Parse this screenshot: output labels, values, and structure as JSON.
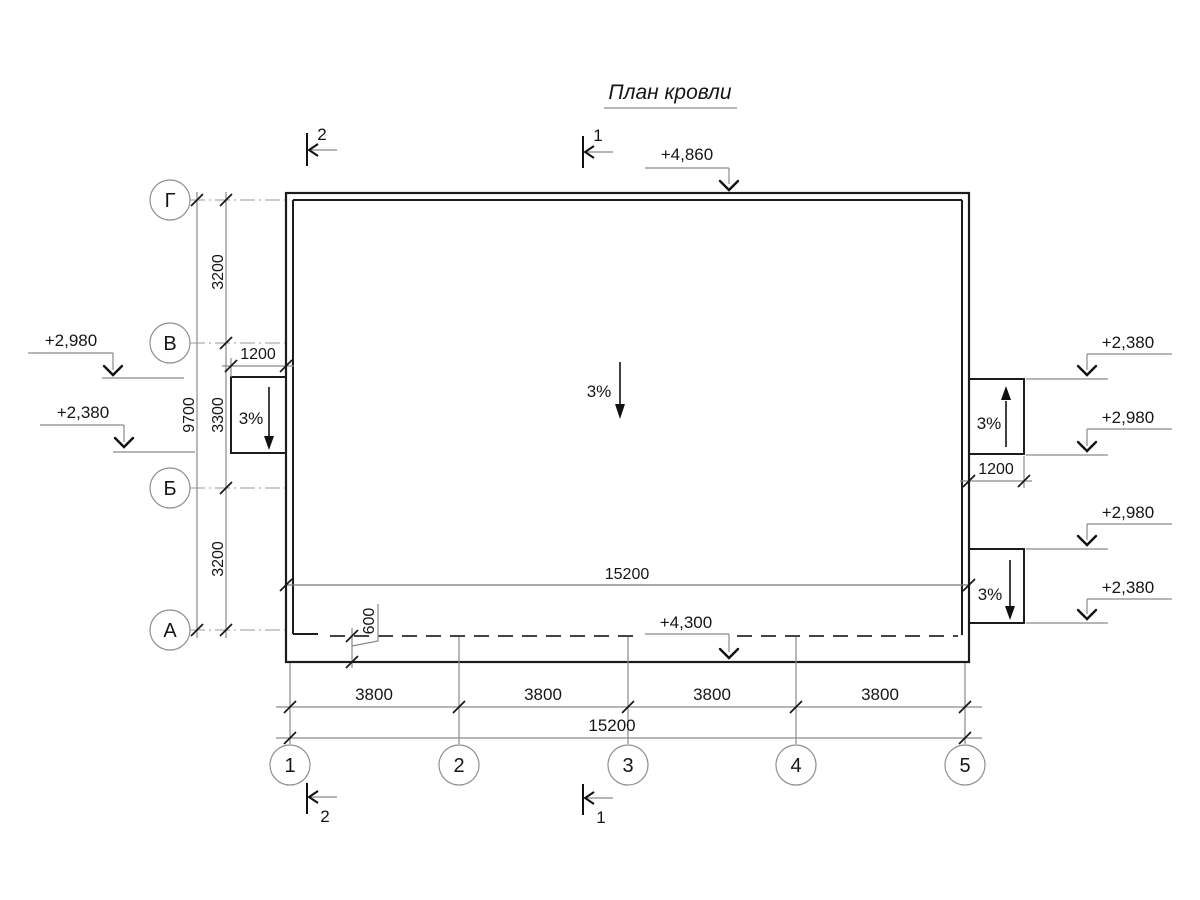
{
  "title": "План кровли",
  "sections": {
    "top_left": "2",
    "top_center": "1",
    "bottom_left": "2",
    "bottom_center": "1"
  },
  "elevations": {
    "ridge": "+4,860",
    "eaves": "+4,300",
    "left": [
      "+2,980",
      "+2,380"
    ],
    "right": [
      "+2,380",
      "+2,980",
      "+2,980",
      "+2,380"
    ]
  },
  "slopes": {
    "main": "3%",
    "left_canopy": "3%",
    "right_upper_canopy": "3%",
    "right_lower_canopy": "3%"
  },
  "grid": {
    "rows": [
      "Г",
      "В",
      "Б",
      "А"
    ],
    "columns": [
      "1",
      "2",
      "3",
      "4",
      "5"
    ]
  },
  "dimensions": {
    "row_spans": [
      "3200",
      "3300",
      "3200"
    ],
    "row_total": "9700",
    "column_spans": [
      "3800",
      "3800",
      "3800",
      "3800"
    ],
    "column_total": "15200",
    "roof_width": "15200",
    "canopy_width_left": "1200",
    "canopy_width_right": "1200",
    "overhang": "600"
  }
}
